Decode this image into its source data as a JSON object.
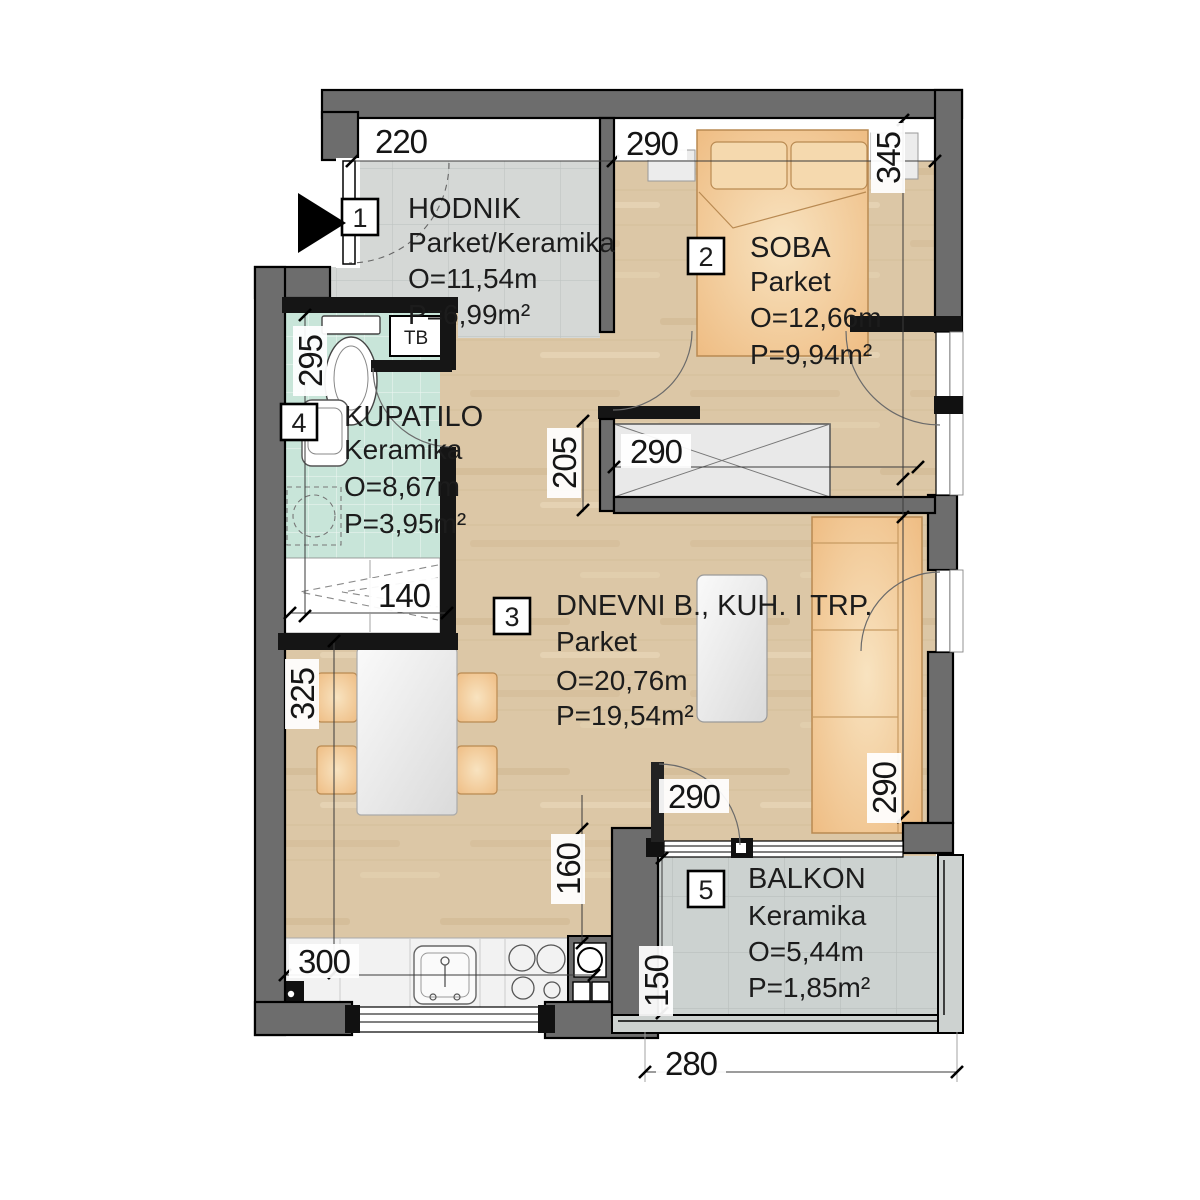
{
  "rooms": {
    "hodnik": {
      "number": "1",
      "name": "HODNIK",
      "floor": "Parket/Keramika",
      "perimeter": "O=11,54m",
      "area": "P=6,99m²"
    },
    "soba": {
      "number": "2",
      "name": "SOBA",
      "floor": "Parket",
      "perimeter": "O=12,66m",
      "area": "P=9,94m²"
    },
    "dnevni": {
      "number": "3",
      "name": "DNEVNI B., KUH. I TRP.",
      "floor": "Parket",
      "perimeter": "O=20,76m",
      "area": "P=19,54m²"
    },
    "kupatilo": {
      "number": "4",
      "name": "KUPATILO",
      "floor": "Keramika",
      "perimeter": "O=8,67m",
      "area": "P=3,95m²"
    },
    "balkon": {
      "number": "5",
      "name": "BALKON",
      "floor": "Keramika",
      "perimeter": "O=5,44m",
      "area": "P=1,85m²"
    }
  },
  "labels": {
    "boiler": "TB"
  },
  "dims": [
    "220",
    "290",
    "345",
    "295",
    "205",
    "290",
    "140",
    "325",
    "290",
    "160",
    "290",
    "300",
    "150",
    "280"
  ],
  "colors": {
    "wall": "#6d6d6d",
    "wood": "#dcc7a6",
    "hall_tile": "#d5d8d6",
    "balcony_tile": "#cdd3d1",
    "bath_tile": "#c9e6da",
    "furniture": "#f2cb96",
    "furniture_edge": "#b98a52",
    "text": "#1c1c1c"
  }
}
